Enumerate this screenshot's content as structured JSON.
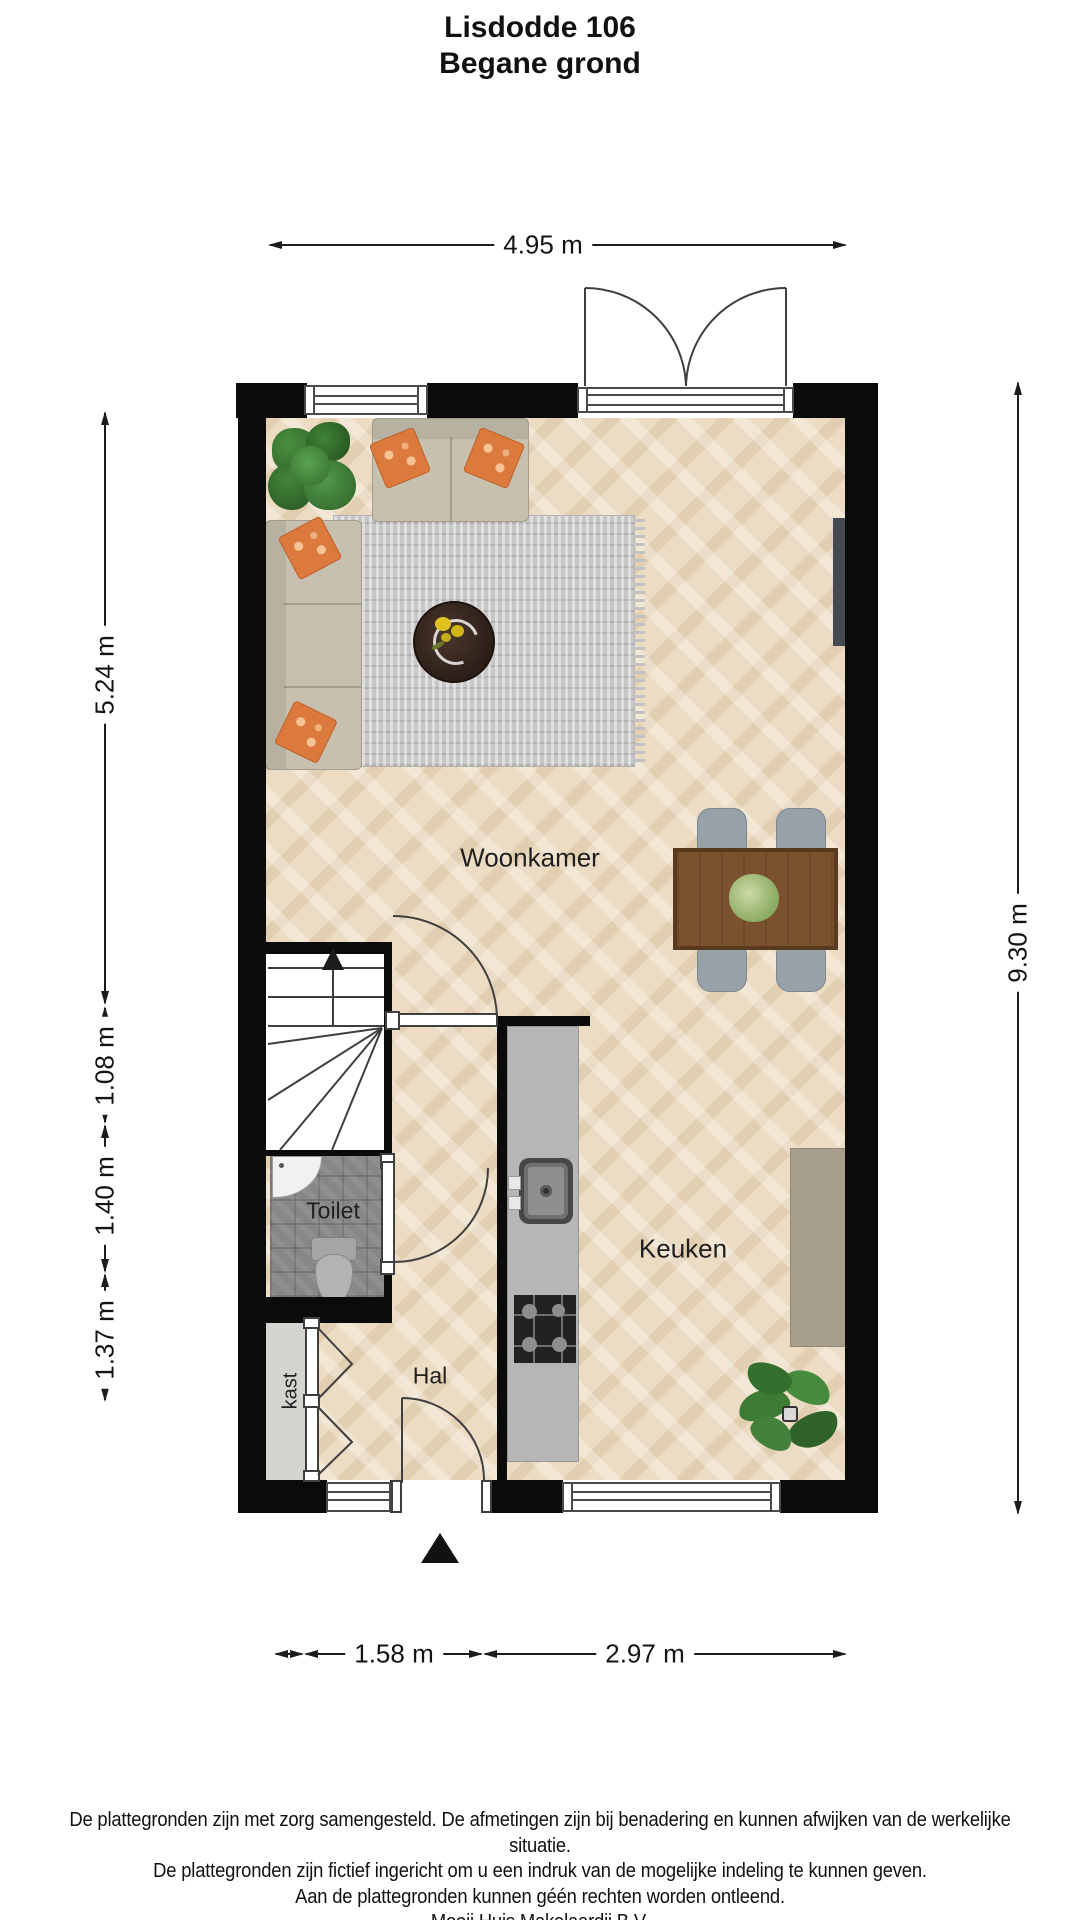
{
  "header": {
    "line1": "Lisdodde 106",
    "line2": "Begane grond"
  },
  "rooms": {
    "living": "Woonkamer",
    "kitchen": "Keuken",
    "toilet": "Toilet",
    "hall": "Hal",
    "closet": "kast"
  },
  "dimensions": {
    "top": "4.95 m",
    "left": [
      "5.24 m",
      "1.08 m",
      "1.40 m",
      "1.37 m"
    ],
    "right": "9.30 m",
    "bottom": [
      "1.58 m",
      "2.97 m"
    ]
  },
  "footer": {
    "lines": [
      "De plattegronden zijn met zorg samengesteld. De afmetingen zijn bij benadering en kunnen afwijken van de werkelijke situatie.",
      "De plattegronden zijn fictief ingericht om u een indruk van de mogelijke indeling te kunnen geven.",
      "Aan de plattegronden kunnen géén rechten worden ontleend.",
      "Mooij Huis Makelaardij B.V."
    ]
  },
  "icons": {
    "entrance_arrow": "up-triangle",
    "stairs_direction": "up-arrow"
  },
  "colors": {
    "wall": "#0b0b0b",
    "floor": "#ecdcc3",
    "rug": "#c7c7c7",
    "toilet_floor": "#878787",
    "closet_floor": "#d6d4d0",
    "sofa": "#c7c0af",
    "pillow_orange": "#dc7a3e",
    "dining_table": "#7b5230",
    "chair": "#97a1aa",
    "counter": "#b6b6b6",
    "cabinet": "#a79e8e",
    "plant_green": "#3c7a35"
  }
}
